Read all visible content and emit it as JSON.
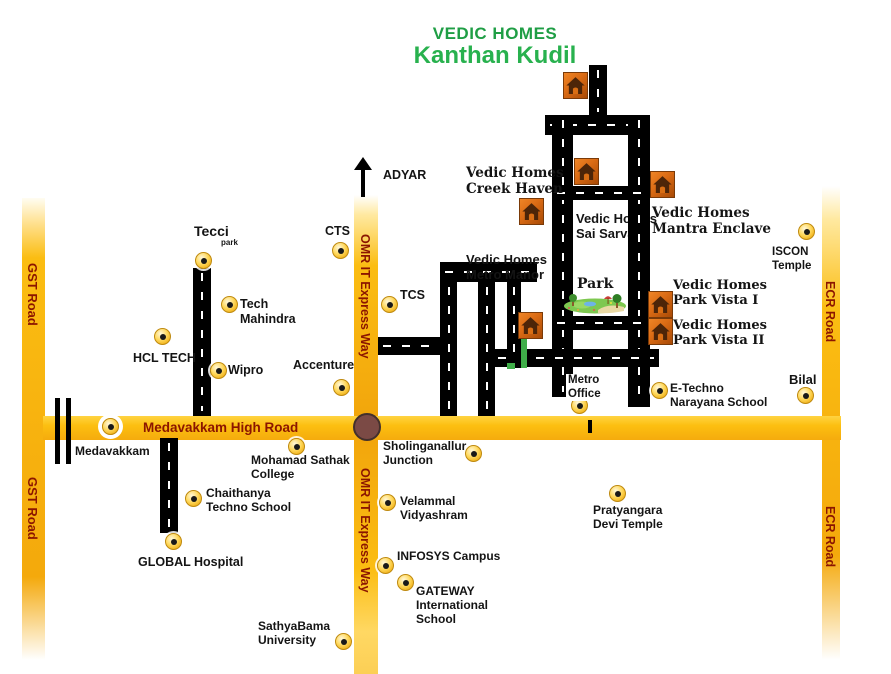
{
  "title": {
    "line1": "VEDIC HOMES",
    "line2": "Kanthan Kudil",
    "line1_color": "#1f9e45",
    "line2_color": "#28b14e"
  },
  "colors": {
    "road_yellow": "#fcbf10",
    "road_yellow_dark": "#f2a60c",
    "road_label_maroon": "#8b1500",
    "black_road": "#000000",
    "junction_circle": "#7b4a45",
    "site_green": "#3fae49",
    "house_orange": "#d96a14",
    "house_brown": "#4d2508",
    "marker_yellow": "#ffd95e",
    "title_green": "#28b14e"
  },
  "roads": {
    "yellow": [
      {
        "id": "gst-road",
        "x": 22,
        "y": 198,
        "w": 23,
        "h": 462
      },
      {
        "id": "omr-upper",
        "x": 354,
        "y": 195,
        "w": 24,
        "h": 221
      },
      {
        "id": "omr-lower",
        "x": 354,
        "y": 440,
        "w": 24,
        "h": 234
      },
      {
        "id": "ecr-road",
        "x": 822,
        "y": 186,
        "w": 18,
        "h": 474
      },
      {
        "id": "medavakkam-high-road",
        "x": 43,
        "y": 416,
        "w": 798,
        "h": 24
      }
    ],
    "black": [
      {
        "id": "north-stub",
        "o": "v",
        "x": 589,
        "y": 65,
        "w": 18,
        "h": 52
      },
      {
        "id": "rect-top",
        "o": "h",
        "x": 545,
        "y": 115,
        "w": 105,
        "h": 20
      },
      {
        "id": "rect-left",
        "o": "v",
        "x": 552,
        "y": 115,
        "w": 21,
        "h": 282
      },
      {
        "id": "rect-right",
        "o": "v",
        "x": 628,
        "y": 115,
        "w": 22,
        "h": 292
      },
      {
        "id": "rect-mid",
        "o": "h",
        "x": 552,
        "y": 186,
        "w": 96,
        "h": 14
      },
      {
        "id": "rect-bottom",
        "o": "h",
        "x": 552,
        "y": 316,
        "w": 96,
        "h": 14
      },
      {
        "id": "south-cross",
        "o": "h",
        "x": 493,
        "y": 349,
        "w": 166,
        "h": 18
      },
      {
        "id": "west-top",
        "o": "h",
        "x": 440,
        "y": 262,
        "w": 97,
        "h": 20
      },
      {
        "id": "west-v1",
        "o": "v",
        "x": 440,
        "y": 282,
        "w": 17,
        "h": 134
      },
      {
        "id": "west-v2",
        "o": "v",
        "x": 478,
        "y": 282,
        "w": 17,
        "h": 134
      },
      {
        "id": "west-v3",
        "o": "v",
        "x": 507,
        "y": 282,
        "w": 14,
        "h": 86
      },
      {
        "id": "omr-stub",
        "o": "h",
        "x": 378,
        "y": 337,
        "w": 64,
        "h": 18
      },
      {
        "id": "tecci-road",
        "o": "v",
        "x": 193,
        "y": 268,
        "w": 18,
        "h": 148
      },
      {
        "id": "global-road",
        "o": "v",
        "x": 160,
        "y": 438,
        "w": 18,
        "h": 95
      }
    ]
  },
  "railway": {
    "bars": [
      {
        "x": 55,
        "y": 398,
        "w": 5,
        "h": 66
      },
      {
        "x": 66,
        "y": 398,
        "w": 5,
        "h": 66
      }
    ]
  },
  "road_labels": [
    {
      "id": "gst-upper",
      "text": "GST Road",
      "x": 25,
      "y": 263,
      "vertical": true,
      "size": 13
    },
    {
      "id": "gst-lower",
      "text": "GST Road",
      "x": 25,
      "y": 477,
      "vertical": true,
      "size": 13
    },
    {
      "id": "omr-upper-label",
      "text": "OMR IT Express Way",
      "x": 358,
      "y": 234,
      "vertical": true,
      "size": 12.5
    },
    {
      "id": "omr-lower-label",
      "text": "OMR IT Express Way",
      "x": 358,
      "y": 468,
      "vertical": true,
      "size": 12.5
    },
    {
      "id": "ecr-upper",
      "text": "ECR Road",
      "x": 823,
      "y": 281,
      "vertical": true,
      "size": 12.5
    },
    {
      "id": "ecr-lower",
      "text": "ECR Road",
      "x": 823,
      "y": 506,
      "vertical": true,
      "size": 12.5
    },
    {
      "id": "medavakkam-high-road-label",
      "text": "Medavakkam High Road",
      "x": 143,
      "y": 420,
      "vertical": false,
      "size": 13.5
    }
  ],
  "junction": {
    "x": 367,
    "y": 427,
    "r": 14
  },
  "marks": [
    {
      "id": "site-green-line",
      "cls": "green-mark",
      "x": 521,
      "y": 335,
      "w": 6,
      "h": 33
    },
    {
      "id": "site-green-dash",
      "cls": "green-mark",
      "x": 507,
      "y": 363,
      "w": 8,
      "h": 6
    },
    {
      "id": "road-tick",
      "cls": "black-tick",
      "x": 588,
      "y": 420,
      "w": 4,
      "h": 13
    }
  ],
  "park": {
    "x": 564,
    "y": 291,
    "w": 63,
    "h": 23
  },
  "houses": [
    {
      "id": "house-north"
    },
    {
      "id": "house-sai-sarva"
    },
    {
      "id": "house-creek-haven"
    },
    {
      "id": "house-mantra-enclave"
    },
    {
      "id": "house-park-vista-1"
    },
    {
      "id": "house-park-vista-2"
    },
    {
      "id": "house-site"
    }
  ],
  "house_positions": [
    {
      "id": "house-north",
      "x": 563,
      "y": 72
    },
    {
      "id": "house-sai-sarva",
      "x": 574,
      "y": 158
    },
    {
      "id": "house-creek-haven",
      "x": 519,
      "y": 198
    },
    {
      "id": "house-mantra-enclave",
      "x": 650,
      "y": 171
    },
    {
      "id": "house-park-vista-1",
      "x": 648,
      "y": 291
    },
    {
      "id": "house-park-vista-2",
      "x": 648,
      "y": 318
    },
    {
      "id": "house-site",
      "x": 518,
      "y": 312
    }
  ],
  "markers": [
    {
      "id": "tecci-park",
      "x": 203,
      "y": 260
    },
    {
      "id": "cts",
      "x": 340,
      "y": 250
    },
    {
      "id": "tcs",
      "x": 389,
      "y": 304
    },
    {
      "id": "tech-mahindra",
      "x": 229,
      "y": 304
    },
    {
      "id": "hcl-tech",
      "x": 162,
      "y": 336
    },
    {
      "id": "wipro",
      "x": 218,
      "y": 370
    },
    {
      "id": "accenture",
      "x": 341,
      "y": 387
    },
    {
      "id": "medavakkam-road",
      "x": 110,
      "y": 426,
      "white_bg": true
    },
    {
      "id": "mohamad-sathak",
      "x": 296,
      "y": 446
    },
    {
      "id": "sholinganallur",
      "x": 473,
      "y": 453
    },
    {
      "id": "chaithanya",
      "x": 193,
      "y": 498
    },
    {
      "id": "global-hospital",
      "x": 173,
      "y": 541
    },
    {
      "id": "velammal",
      "x": 387,
      "y": 502
    },
    {
      "id": "infosys",
      "x": 385,
      "y": 565
    },
    {
      "id": "gateway",
      "x": 405,
      "y": 582
    },
    {
      "id": "sathyabama",
      "x": 343,
      "y": 641
    },
    {
      "id": "metro-office",
      "x": 579,
      "y": 405
    },
    {
      "id": "e-techno",
      "x": 659,
      "y": 390
    },
    {
      "id": "bilal",
      "x": 805,
      "y": 395
    },
    {
      "id": "iscon",
      "x": 806,
      "y": 231
    },
    {
      "id": "pratyangara",
      "x": 617,
      "y": 493
    }
  ],
  "texts": [
    {
      "id": "tecci",
      "lines": [
        "Tecci"
      ],
      "x": 194,
      "y": 223,
      "size": 14
    },
    {
      "id": "tecci-park",
      "lines": [
        "park"
      ],
      "x": 221,
      "y": 238,
      "size": 8
    },
    {
      "id": "cts",
      "lines": [
        "CTS"
      ],
      "x": 325,
      "y": 224,
      "size": 12.5
    },
    {
      "id": "tcs",
      "lines": [
        "TCS"
      ],
      "x": 400,
      "y": 288,
      "size": 12.5
    },
    {
      "id": "tech-mahindra",
      "lines": [
        "Tech",
        "Mahindra"
      ],
      "x": 240,
      "y": 297,
      "size": 12.5
    },
    {
      "id": "hcl-tech",
      "lines": [
        "HCL TECH"
      ],
      "x": 133,
      "y": 351,
      "size": 12.5
    },
    {
      "id": "wipro",
      "lines": [
        "Wipro"
      ],
      "x": 228,
      "y": 363,
      "size": 12.5
    },
    {
      "id": "accenture",
      "lines": [
        "Accenture"
      ],
      "x": 293,
      "y": 358,
      "size": 12.5
    },
    {
      "id": "adyar",
      "lines": [
        "ADYAR"
      ],
      "x": 383,
      "y": 168,
      "size": 12.5
    },
    {
      "id": "medavakkam",
      "lines": [
        "Medavakkam"
      ],
      "x": 75,
      "y": 444,
      "size": 12
    },
    {
      "id": "mohamad-sathak",
      "lines": [
        "Mohamad Sathak",
        "College"
      ],
      "x": 251,
      "y": 453,
      "size": 12
    },
    {
      "id": "sholinganallur",
      "lines": [
        "Sholinganallur",
        "Junction"
      ],
      "x": 383,
      "y": 439,
      "size": 12
    },
    {
      "id": "chaithanya",
      "lines": [
        "Chaithanya",
        "Techno School"
      ],
      "x": 206,
      "y": 486,
      "size": 12
    },
    {
      "id": "global-hospital",
      "lines": [
        "GLOBAL Hospital"
      ],
      "x": 138,
      "y": 555,
      "size": 12.5
    },
    {
      "id": "velammal",
      "lines": [
        "Velammal",
        "Vidyashram"
      ],
      "x": 400,
      "y": 494,
      "size": 12
    },
    {
      "id": "infosys",
      "lines": [
        "INFOSYS Campus"
      ],
      "x": 397,
      "y": 549,
      "size": 12
    },
    {
      "id": "gateway",
      "lines": [
        "GATEWAY",
        "International",
        "School"
      ],
      "x": 416,
      "y": 584,
      "size": 12
    },
    {
      "id": "sathyabama",
      "lines": [
        "SathyaBama",
        "University"
      ],
      "x": 258,
      "y": 619,
      "size": 12
    },
    {
      "id": "metro-office",
      "lines": [
        "Metro",
        "Office"
      ],
      "x": 566,
      "y": 374,
      "size": 11.5,
      "white_bg": true
    },
    {
      "id": "e-techno",
      "lines": [
        "E-Techno",
        "Narayana School"
      ],
      "x": 670,
      "y": 381,
      "size": 12
    },
    {
      "id": "bilal",
      "lines": [
        "Bilal"
      ],
      "x": 789,
      "y": 372,
      "size": 13
    },
    {
      "id": "iscon",
      "lines": [
        "ISCON",
        "Temple"
      ],
      "x": 772,
      "y": 246,
      "size": 11.5
    },
    {
      "id": "pratyangara",
      "lines": [
        "Pratyangara",
        "Devi Temple"
      ],
      "x": 593,
      "y": 503,
      "size": 12
    },
    {
      "id": "park",
      "lines": [
        "Park"
      ],
      "x": 577,
      "y": 276,
      "size": 14,
      "serif": true
    },
    {
      "id": "vedic-creek-haven",
      "lines": [
        "Vedic Homes",
        "Creek Haven"
      ],
      "x": 466,
      "y": 166,
      "size": 13.5,
      "serif": true
    },
    {
      "id": "vedic-sai-sarva",
      "lines": [
        "Vedic Homes",
        "Sai Sarva"
      ],
      "x": 576,
      "y": 211,
      "size": 13,
      "under": true
    },
    {
      "id": "vedic-mantra-enclave",
      "lines": [
        "Vedic Homes",
        "Mantra Enclave"
      ],
      "x": 652,
      "y": 206,
      "size": 13.5,
      "serif": true
    },
    {
      "id": "vedic-metro-manor",
      "lines": [
        "Vedic Homes",
        "Metro Manor"
      ],
      "x": 466,
      "y": 252,
      "size": 13
    },
    {
      "id": "vedic-park-vista-1",
      "lines": [
        "Vedic Homes",
        "Park Vista I"
      ],
      "x": 673,
      "y": 278,
      "size": 13,
      "serif": true
    },
    {
      "id": "vedic-park-vista-2",
      "lines": [
        "Vedic Homes",
        "Park Vista II"
      ],
      "x": 673,
      "y": 318,
      "size": 13,
      "serif": true
    }
  ]
}
